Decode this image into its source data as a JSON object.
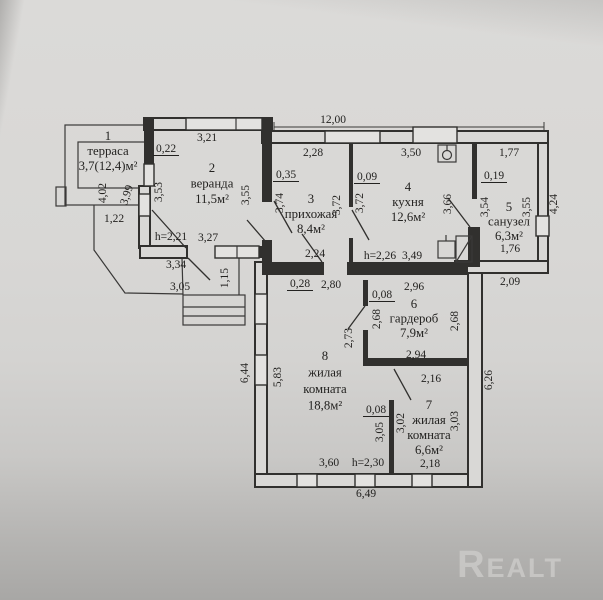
{
  "watermark": "Realt",
  "colors": {
    "paper": "#d7d6d4",
    "ink": "#31302e",
    "shadow": "#a8a7a5",
    "watermark_gray": "#c9c8c6"
  },
  "rooms": [
    {
      "num": "1",
      "name": "терраса",
      "area": "3,7(12,4)м²",
      "lx": 108,
      "ly": 140,
      "lh": 15
    },
    {
      "num": "2",
      "name": "веранда",
      "area": "11,5м²",
      "lx": 212,
      "ly": 172,
      "lh": 15.5
    },
    {
      "num": "3",
      "name": "прихожая",
      "area": "8,4м²",
      "lx": 311,
      "ly": 203,
      "lh": 15
    },
    {
      "num": "4",
      "name": "кухня",
      "area": "12,6м²",
      "lx": 408,
      "ly": 191,
      "lh": 15
    },
    {
      "num": "5",
      "name": "санузел",
      "area": "6,3м²",
      "lx": 509,
      "ly": 211,
      "lh": 14.5
    },
    {
      "num": "6",
      "name": "гардероб",
      "area": "7,9м²",
      "lx": 414,
      "ly": 308,
      "lh": 14.5
    },
    {
      "num": "7",
      "name": "жилая комната",
      "area": "6,6м²",
      "lx": 429,
      "ly": 409,
      "lh": 15
    },
    {
      "num": "8",
      "name": "жилая комната",
      "area": "18,8м²",
      "lx": 325,
      "ly": 360,
      "lh": 16.5
    }
  ],
  "dimensions": [
    {
      "t": "12,00",
      "x": 333,
      "y": 123
    },
    {
      "t": "3,21",
      "x": 207,
      "y": 141
    },
    {
      "t": "0,22",
      "x": 166,
      "y": 152,
      "u": 1
    },
    {
      "t": "2,28",
      "x": 313,
      "y": 156
    },
    {
      "t": "3,50",
      "x": 411,
      "y": 156
    },
    {
      "t": "1,77",
      "x": 509,
      "y": 156
    },
    {
      "t": "0,35",
      "x": 286,
      "y": 178,
      "u": 1
    },
    {
      "t": "0,09",
      "x": 367,
      "y": 180,
      "u": 1
    },
    {
      "t": "0,19",
      "x": 494,
      "y": 179,
      "u": 1
    },
    {
      "t": "4,02",
      "x": 106,
      "y": 193,
      "r": 1
    },
    {
      "t": "3,99",
      "x": 130,
      "y": 196,
      "r": 2
    },
    {
      "t": "3,53",
      "x": 162,
      "y": 192,
      "r": 1
    },
    {
      "t": "3,55",
      "x": 249,
      "y": 195,
      "r": 1
    },
    {
      "t": "3,74",
      "x": 283,
      "y": 203,
      "r": 1
    },
    {
      "t": "3,72",
      "x": 340,
      "y": 205,
      "r": 1
    },
    {
      "t": "3,72",
      "x": 363,
      "y": 203,
      "r": 1
    },
    {
      "t": "3,66",
      "x": 451,
      "y": 204,
      "r": 1
    },
    {
      "t": "3,54",
      "x": 488,
      "y": 207,
      "r": 1
    },
    {
      "t": "3,55",
      "x": 530,
      "y": 207,
      "r": 1
    },
    {
      "t": "4,24",
      "x": 557,
      "y": 204,
      "r": 1
    },
    {
      "t": "1,22",
      "x": 114,
      "y": 222
    },
    {
      "t": "h=2,21",
      "x": 171,
      "y": 240
    },
    {
      "t": "3,27",
      "x": 208,
      "y": 241
    },
    {
      "t": "1,76",
      "x": 510,
      "y": 252
    },
    {
      "t": "2,24",
      "x": 315,
      "y": 257
    },
    {
      "t": "h=2,26",
      "x": 380,
      "y": 259
    },
    {
      "t": "3,49",
      "x": 412,
      "y": 259
    },
    {
      "t": "3,34",
      "x": 176,
      "y": 268
    },
    {
      "t": "1,15",
      "x": 228,
      "y": 278,
      "r": 1
    },
    {
      "t": "2,09",
      "x": 510,
      "y": 285
    },
    {
      "t": "0,28",
      "x": 300,
      "y": 287,
      "u": 1
    },
    {
      "t": "2,80",
      "x": 331,
      "y": 288
    },
    {
      "t": "3,05",
      "x": 180,
      "y": 290
    },
    {
      "t": "2,96",
      "x": 414,
      "y": 290
    },
    {
      "t": "0,08",
      "x": 382,
      "y": 298,
      "u": 1
    },
    {
      "t": "2,68",
      "x": 380,
      "y": 319,
      "r": 1
    },
    {
      "t": "2,73",
      "x": 352,
      "y": 338,
      "r": 1
    },
    {
      "t": "2,68",
      "x": 458,
      "y": 321,
      "r": 1
    },
    {
      "t": "2,94",
      "x": 416,
      "y": 358
    },
    {
      "t": "6,44",
      "x": 248,
      "y": 373,
      "r": 1
    },
    {
      "t": "5,83",
      "x": 281,
      "y": 377,
      "r": 1
    },
    {
      "t": "6,26",
      "x": 492,
      "y": 380,
      "r": 1
    },
    {
      "t": "2,16",
      "x": 431,
      "y": 382
    },
    {
      "t": "0,08",
      "x": 376,
      "y": 413,
      "u": 1
    },
    {
      "t": "3,05",
      "x": 383,
      "y": 432,
      "r": 1
    },
    {
      "t": "3,02",
      "x": 404,
      "y": 423,
      "r": 1
    },
    {
      "t": "3,03",
      "x": 458,
      "y": 421,
      "r": 1
    },
    {
      "t": "3,60",
      "x": 329,
      "y": 466
    },
    {
      "t": "h=2,30",
      "x": 368,
      "y": 466
    },
    {
      "t": "2,18",
      "x": 430,
      "y": 467
    },
    {
      "t": "6,49",
      "x": 366,
      "y": 497
    }
  ]
}
